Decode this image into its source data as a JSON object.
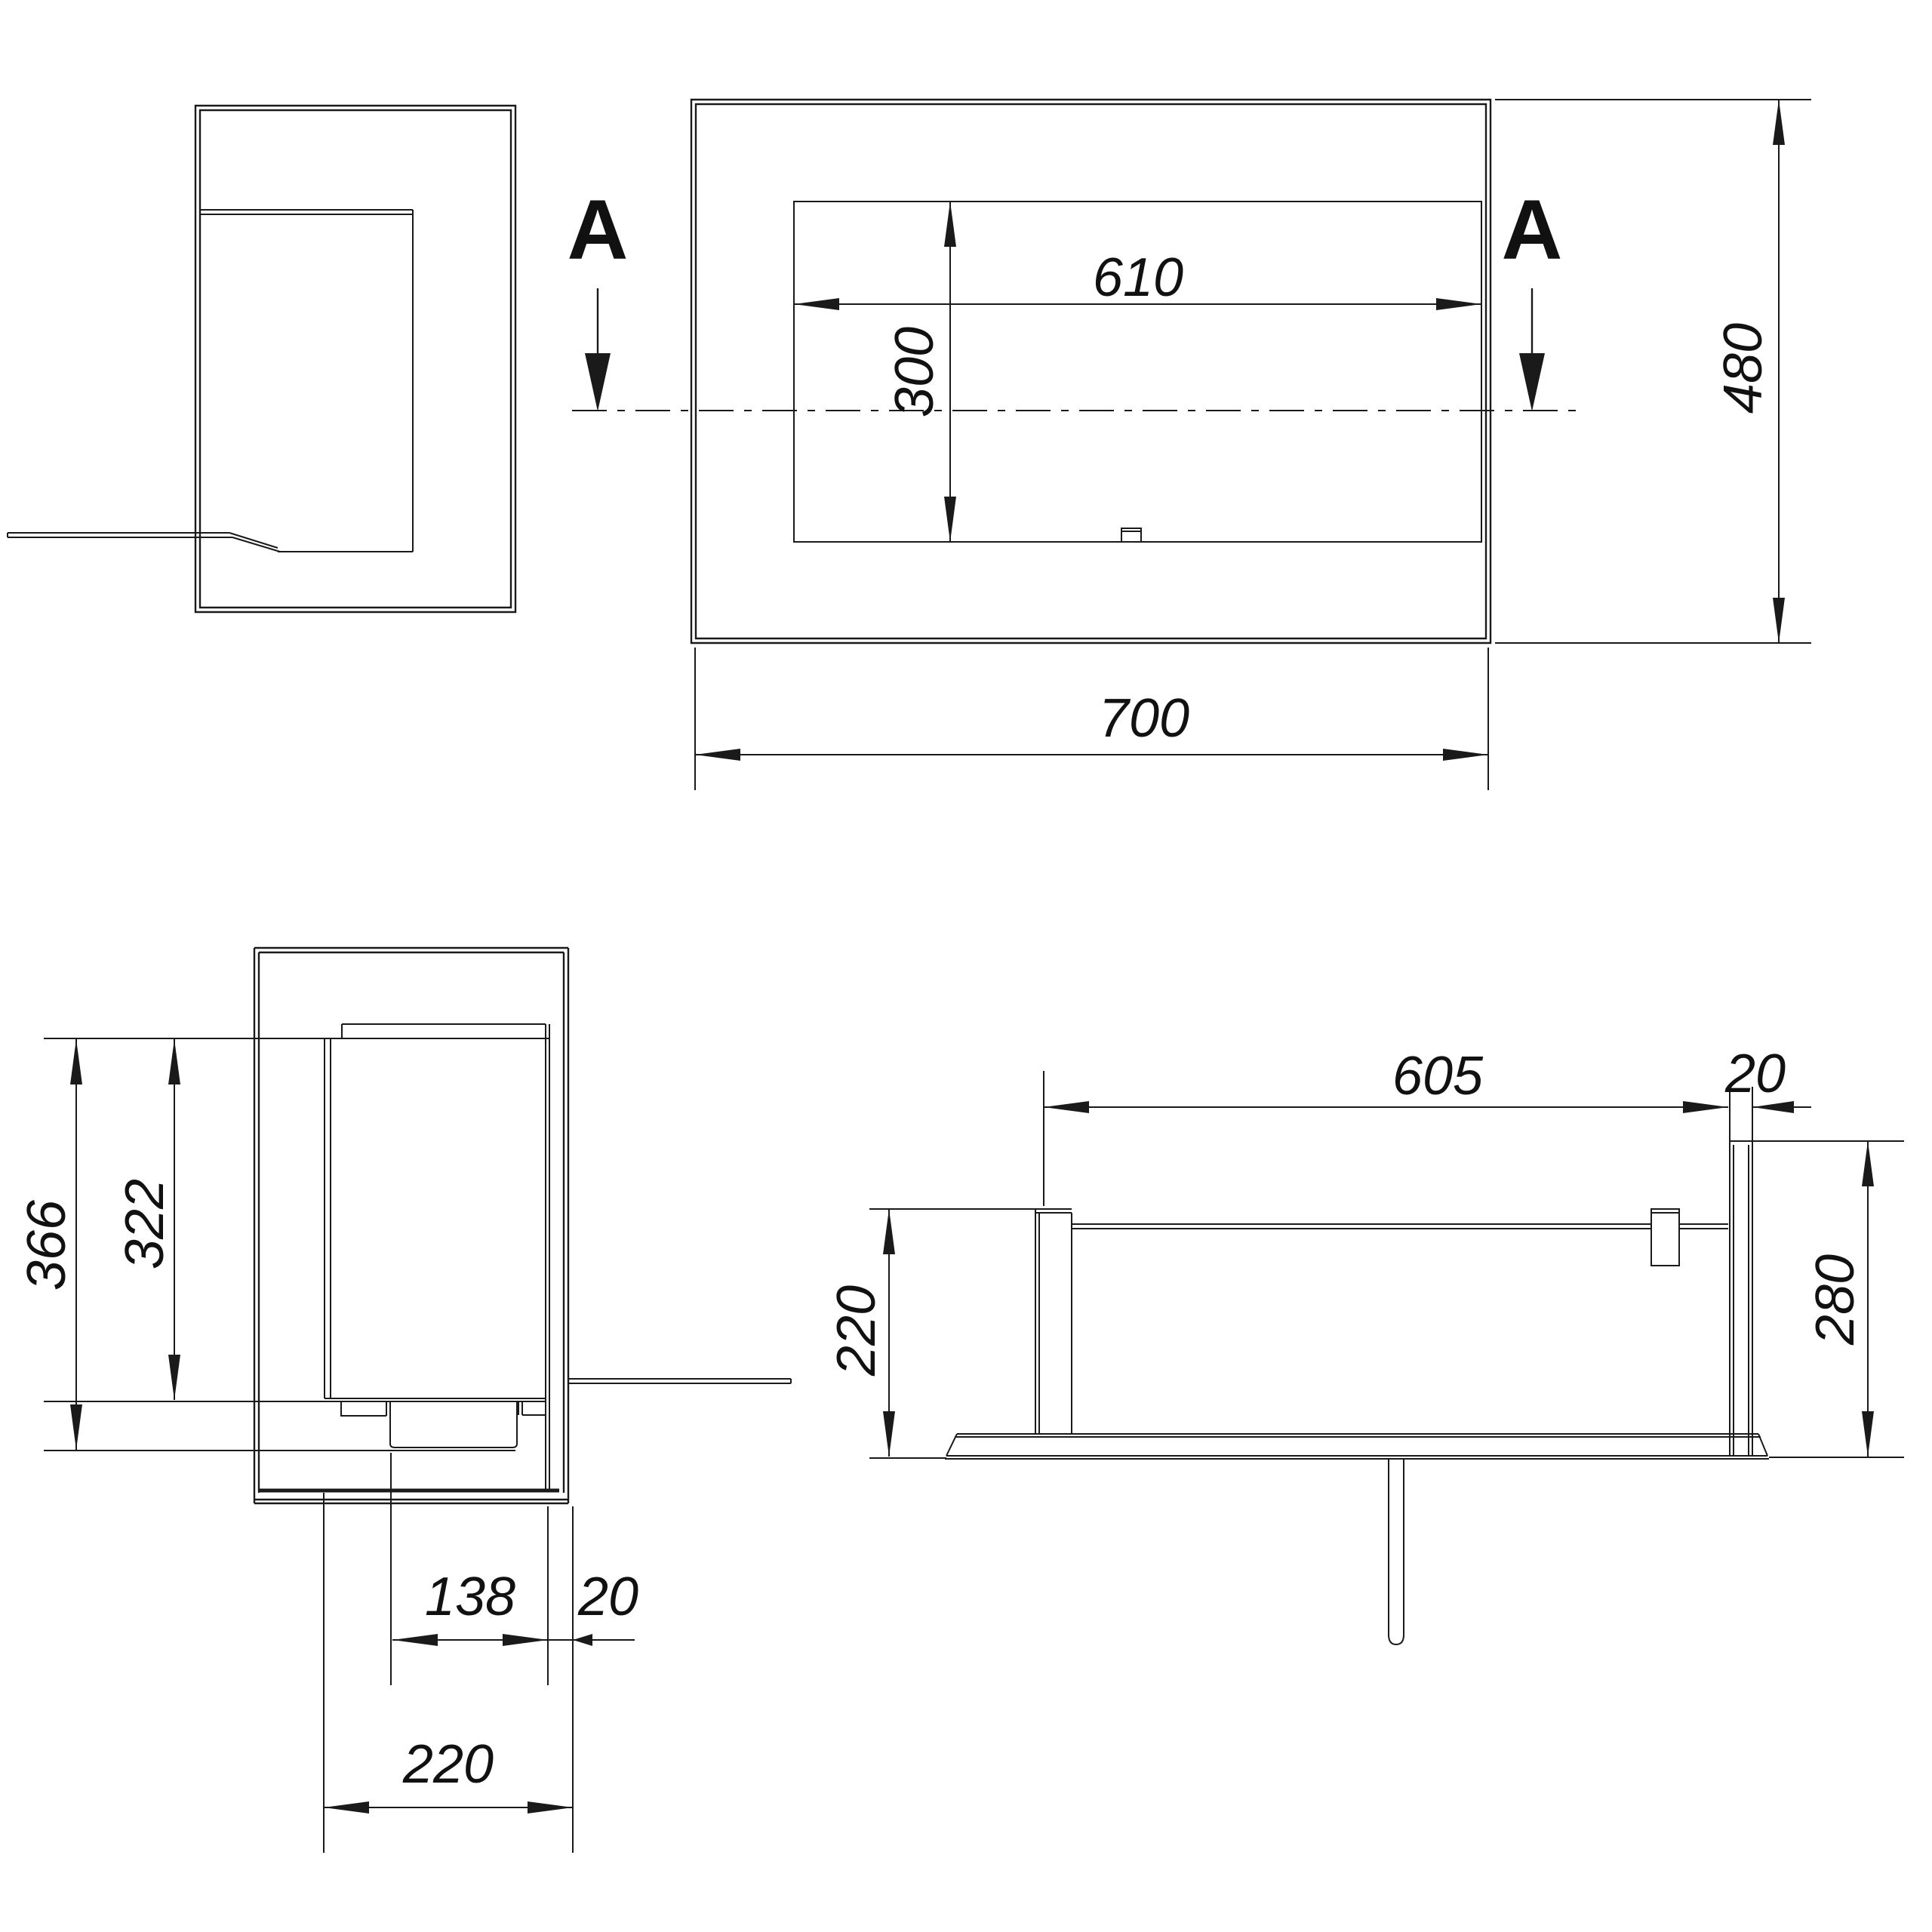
{
  "drawing": {
    "background_color": "#ffffff",
    "line_color": "#1a1a1a",
    "section_marker": "A",
    "front_view": {
      "opening_width": "610",
      "opening_height": "300",
      "overall_width": "700",
      "overall_height": "480"
    },
    "side_section_view": {
      "overall_inner_height": "366",
      "chamber_height": "322",
      "burner_width": "138",
      "edge_offset": "20",
      "depth": "220"
    },
    "plan_section_view": {
      "inner_width": "605",
      "panel_thickness": "20",
      "body_depth": "220",
      "side_panel_depth": "280"
    }
  }
}
